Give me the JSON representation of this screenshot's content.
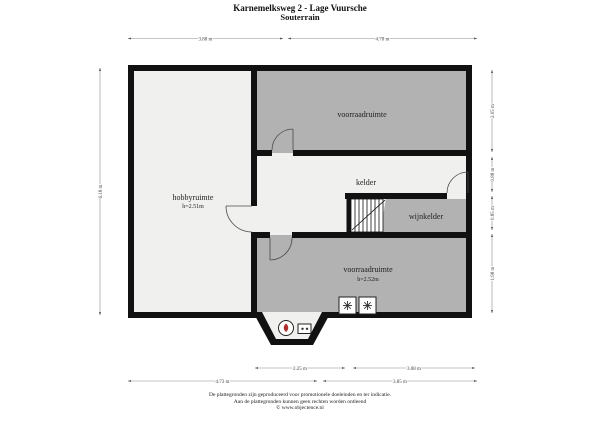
{
  "title": {
    "address": "Karnemelksweg 2 - Lage Vuursche",
    "floor": "Souterrain"
  },
  "rooms": {
    "voorraadruimte_top": {
      "label": "voorraadruimte"
    },
    "hobbyruimte": {
      "label": "hobbyruimte",
      "height": "h=2.51m"
    },
    "kelder": {
      "label": "kelder"
    },
    "wijnkelder": {
      "label": "wijnkelder"
    },
    "voorraadruimte_bottom": {
      "label": "voorraadruimte",
      "height": "h=2.52m"
    }
  },
  "dimensions": {
    "top_left": "3.88 m",
    "top_right": "4.78 m",
    "left_side": "6.18 m",
    "right_top": "2.05 m",
    "right_upper_mid": "0.88 m",
    "right_lower_mid": "0.85 m",
    "right_bottom": "1.98 m",
    "bottom_inner_left": "2.25 m",
    "bottom_inner_right": "3.08 m",
    "bottom_outer_left": "4.73 m",
    "bottom_outer_right": "3.85 m"
  },
  "icons": {
    "washer_symbol": "eight-spoke-asterisk",
    "boiler": "circle-with-red-flame",
    "meter": "panel-with-two-dots"
  },
  "colors": {
    "wall": "#111111",
    "room_dark": "#b2b2b2",
    "room_light": "#f0f0ee",
    "dimension": "#8a8a8a",
    "boiler_accent": "#b03030"
  },
  "footer": {
    "line1": "De plattegronden zijn geproduceerd voor promotionele doeleinden en ter indicatie.",
    "line2": "Aan de plattegronden kunnen geen rechten worden ontleend",
    "line3": "© www.objectence.nl"
  }
}
